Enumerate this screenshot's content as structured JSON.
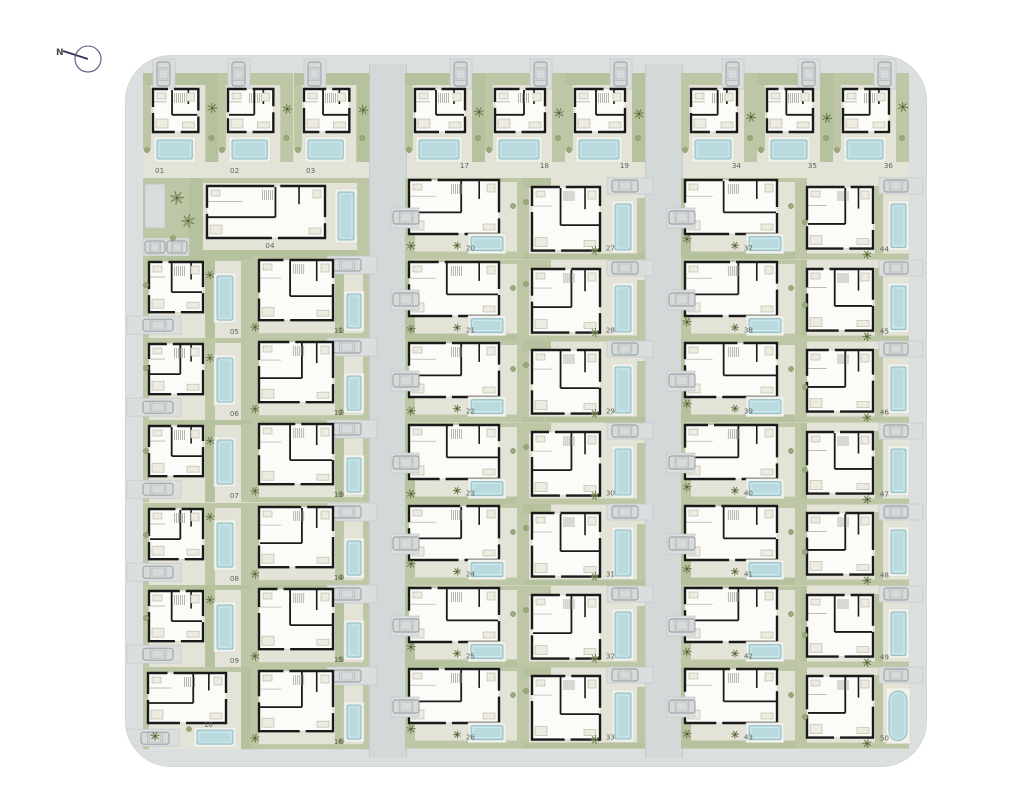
{
  "north": {
    "label": "N"
  },
  "site": {
    "type": "residential-site-plan",
    "total_plots": 50
  },
  "colors": {
    "road": "#d3d8d9",
    "ring_road": "#dcdfe0",
    "plot_ground": "#e4e3d7",
    "green": "#bdc7a5",
    "green_alt": "#b6c19e",
    "green_dark": "#5e6e44",
    "tree_fill": "#8fa06b",
    "pool_water": "#b9dbe0",
    "pool_edge": "#94bfc5",
    "pool_deck": "#f2f2ec",
    "wall": "#1a1a1a",
    "house_fill": "#fbfbf7",
    "car_fill": "#d7dadb",
    "car_edge": "#8f9697",
    "driveway": "#dbdedf",
    "label_text": "#63635c"
  },
  "groups": [
    {
      "name": "west",
      "top_row": [
        "01",
        "02",
        "03"
      ],
      "wide_plot": "04",
      "col_a": [
        "05",
        "06",
        "07",
        "08",
        "09",
        "10"
      ],
      "col_b": [
        "11",
        "12",
        "13",
        "14",
        "15",
        "16"
      ]
    },
    {
      "name": "center",
      "top_row": [
        "17",
        "18",
        "19"
      ],
      "col_a": [
        "20",
        "21",
        "22",
        "23",
        "24",
        "25",
        "26"
      ],
      "col_b": [
        "27",
        "28",
        "29",
        "30",
        "31",
        "32",
        "33"
      ]
    },
    {
      "name": "east",
      "top_row": [
        "34",
        "35",
        "36"
      ],
      "col_a": [
        "37",
        "38",
        "39",
        "40",
        "41",
        "42",
        "43"
      ],
      "col_b": [
        "44",
        "45",
        "46",
        "47",
        "48",
        "49",
        "50"
      ]
    }
  ]
}
